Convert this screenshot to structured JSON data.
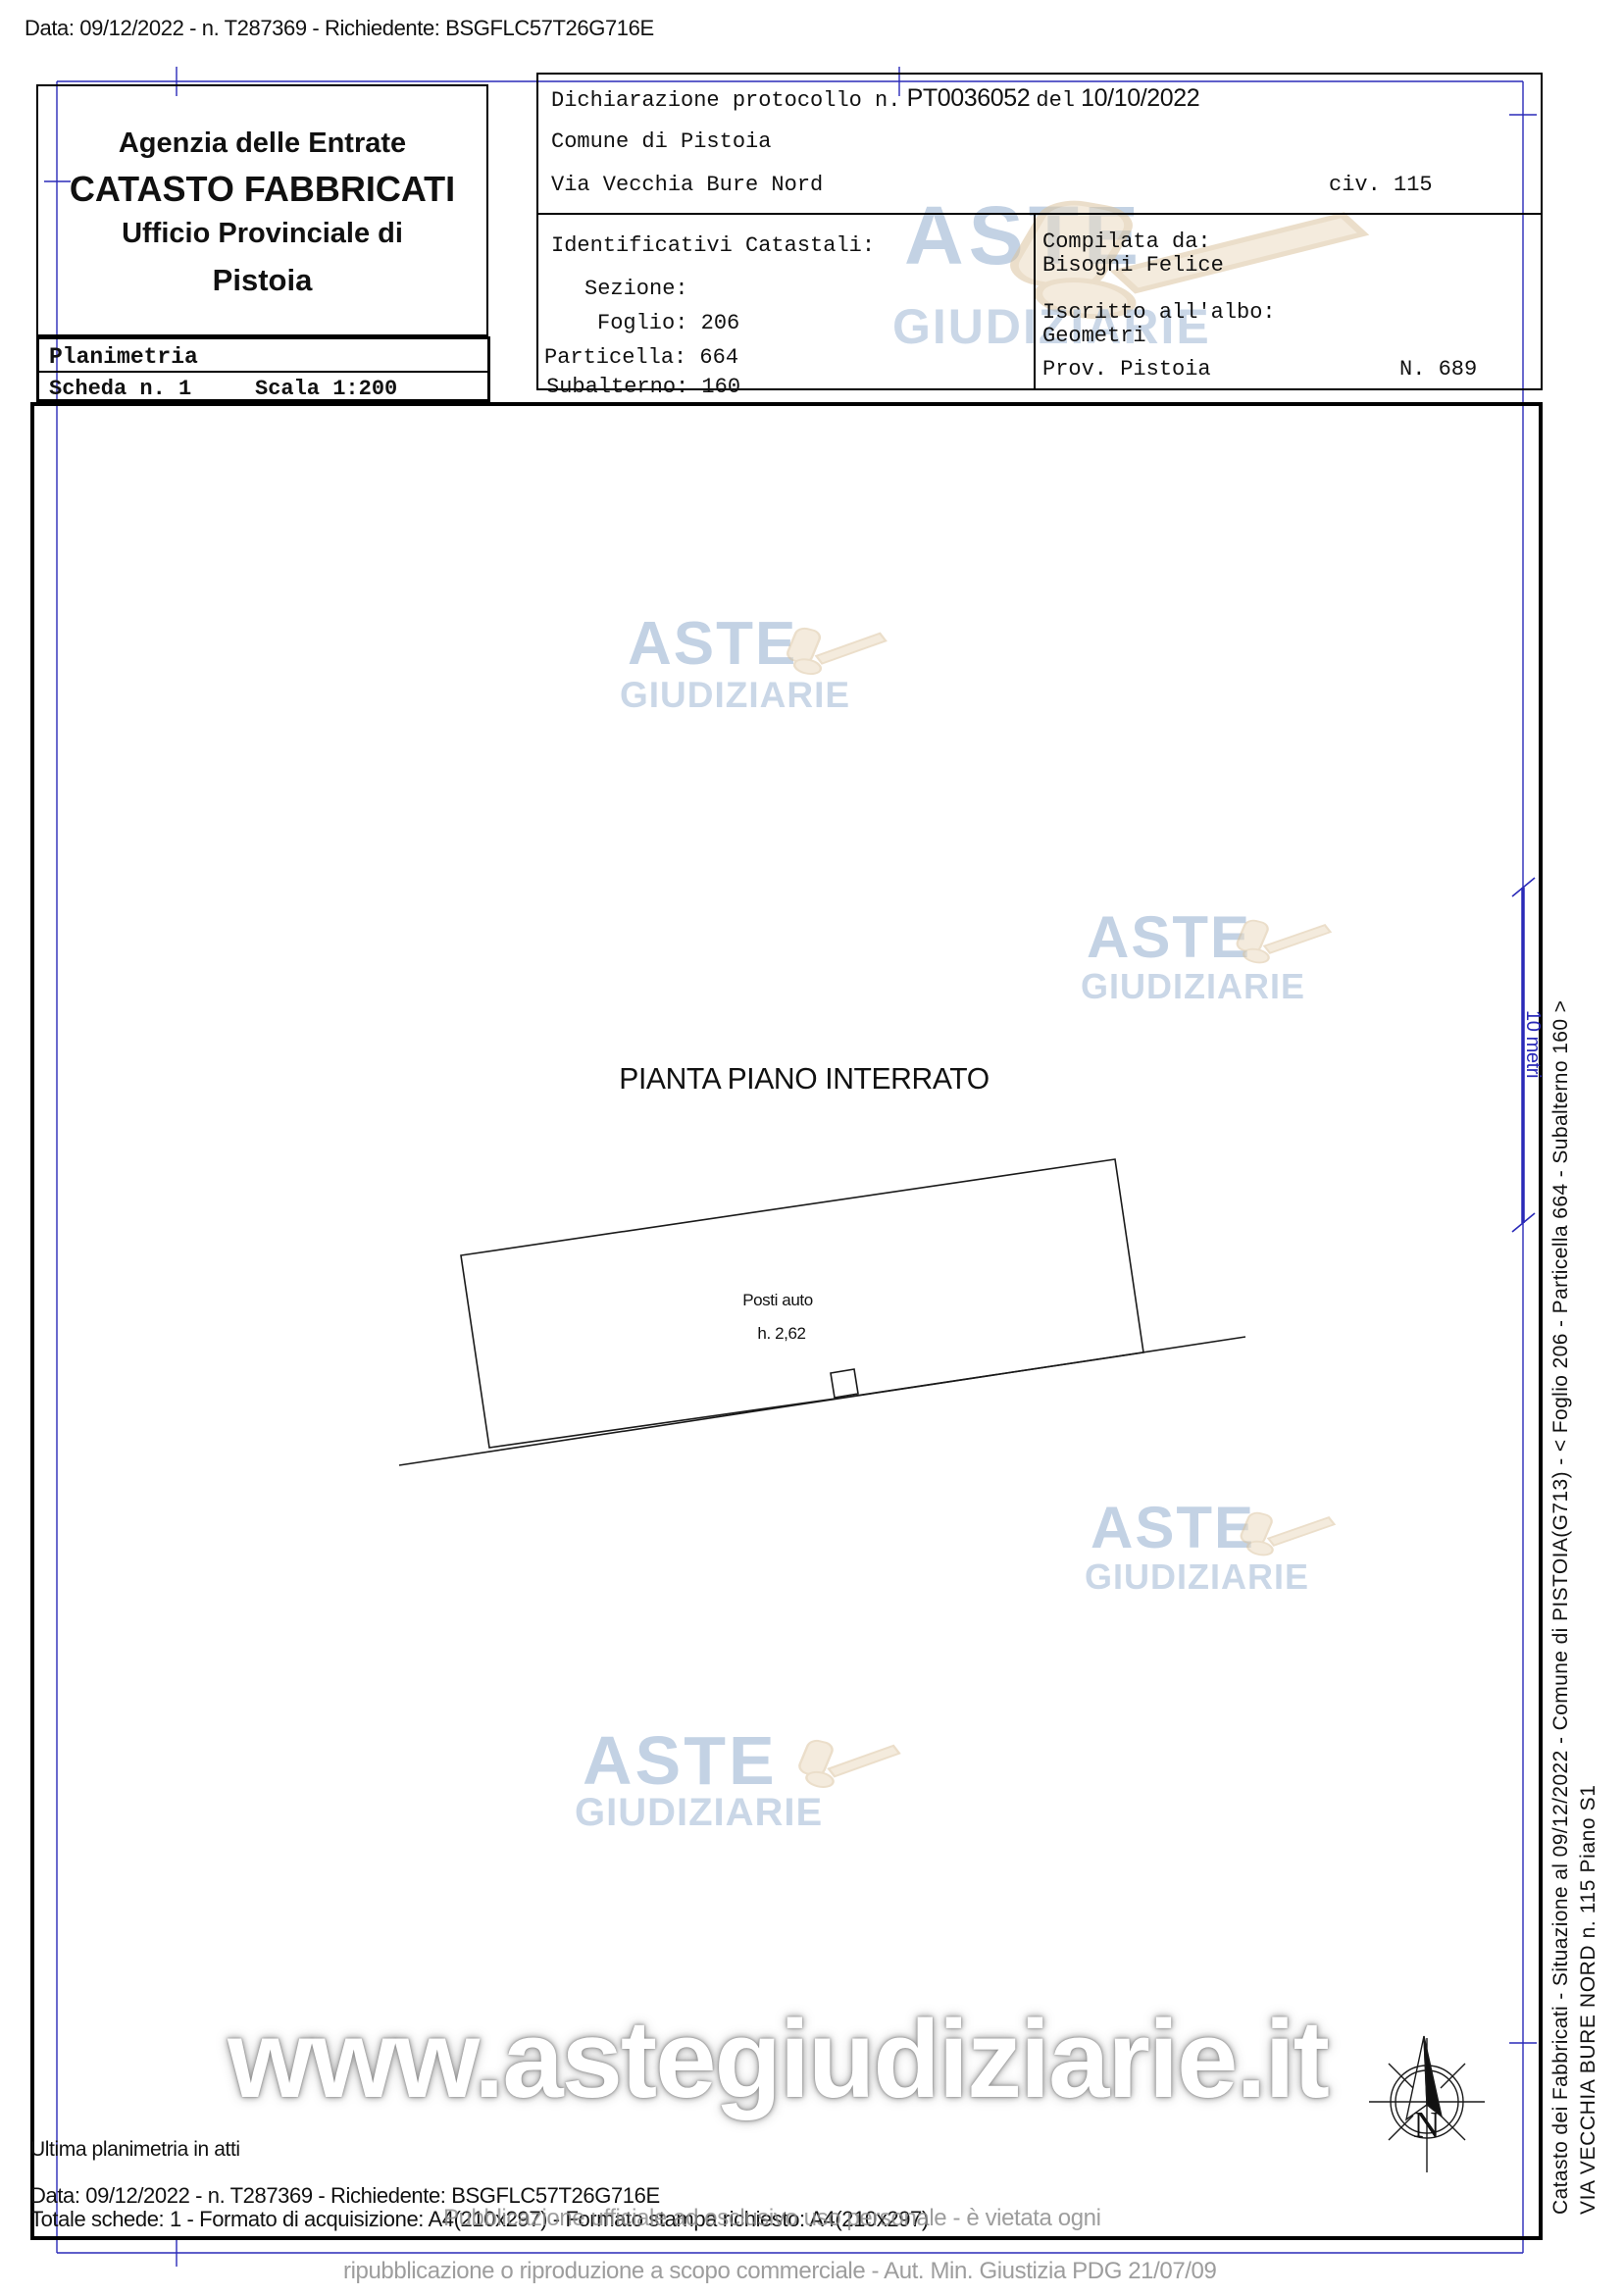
{
  "document": {
    "top_line": "Data: 09/12/2022 - n. T287369 - Richiedente: BSGFLC57T26G716E",
    "agency": {
      "line1": "Agenzia delle Entrate",
      "line2": "CATASTO FABBRICATI",
      "line3": "Ufficio Provinciale di",
      "line4": "Pistoia"
    },
    "planimetria": {
      "title": "Planimetria",
      "scheda": "Scheda n. 1",
      "scala": "Scala 1:200"
    },
    "declaration": {
      "protocol_label": "Dichiarazione protocollo n.",
      "protocol_number": "PT0036052",
      "protocol_del": "del",
      "protocol_date": "10/10/2022",
      "comune": "Comune di Pistoia",
      "street": "Via Vecchia Bure Nord",
      "civic": "civ. 115",
      "cadastral": {
        "title": "Identificativi Catastali:",
        "sezione": "Sezione:",
        "foglio": "Foglio: 206",
        "particella": "Particella: 664",
        "subalterno": "Subalterno: 160"
      },
      "compiler": {
        "label": "Compilata da:",
        "name": "Bisogni Felice",
        "albo_label": "Iscritto all'albo:",
        "albo_value": "Geometri",
        "prov": "Prov. Pistoia",
        "reg_number": "N. 689"
      }
    },
    "plan": {
      "title": "PIANTA PIANO INTERRATO",
      "space_label": "Posti auto",
      "height_label": "h. 2,62"
    },
    "scale_bar_label": "10 metri",
    "compass_label": "N",
    "margin_text": {
      "line1": "Catasto dei Fabbricati - Situazione al 09/12/2022 - Comune di PISTOIA(G713) - < Foglio 206 - Particella 664 - Subalterno 160 >",
      "line2": "VIA VECCHIA BURE NORD n. 115 Piano S1"
    },
    "footer": {
      "ultima": "Ultima planimetria in atti",
      "data_line": "Data: 09/12/2022 - n. T287369 - Richiedente: BSGFLC57T26G716E",
      "totale_line": "Totale schede: 1 - Formato di acquisizione: A4(210x297) - Formato stampa richiesto: A4(210x297)"
    },
    "watermark": {
      "word1": "ASTE",
      "word2": "GIUDIZIARIE",
      "url": "www.astegiudiziarie.it",
      "legal_line1": "Pubblicazione ufficiale ad esclusivo uso personale - è vietata ogni",
      "legal_line2": "ripubblicazione o riproduzione a scopo commerciale - Aut. Min. Giustizia PDG 21/07/09"
    },
    "colors": {
      "registration_blue": "#2a2ab8",
      "watermark_blue": "#a7bdd8",
      "gavel_tan": "#ead9bf",
      "legal_gray": "#8d8d8d"
    }
  }
}
